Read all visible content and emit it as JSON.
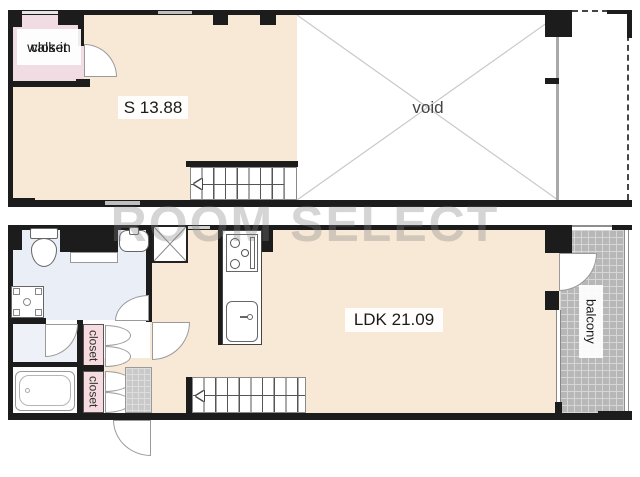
{
  "watermark": {
    "text": "ROOM SELECT"
  },
  "upper_floor": {
    "walk_in_closet": {
      "line1": "walk-in",
      "line2": "closet"
    },
    "room_label": "S 13.88",
    "void_label": "void"
  },
  "lower_floor": {
    "ldk_label": "LDK 21.09",
    "balcony_label": "balcony",
    "closet_upper_label": "closet",
    "closet_lower_label": "closet"
  },
  "colors": {
    "room_fill": "#f8e9d6",
    "walk_in_closet_fill": "#f2dce3",
    "closet_fill": "#f6dbe0",
    "washroom_fill": "#e9eef7",
    "balcony_tile": "#b7b7b7",
    "entrance_tile": "#c9c9c9",
    "wall": "#1c1c1c",
    "watermark_gray": "#808080"
  }
}
